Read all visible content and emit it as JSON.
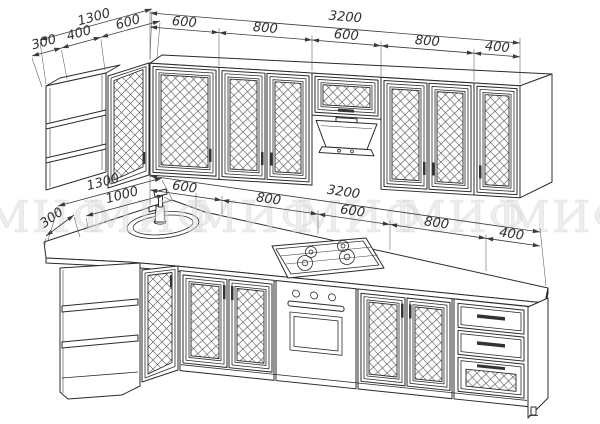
{
  "document": {
    "type": "kitchen furniture technical line drawing, isometric view"
  },
  "watermark": {
    "text": "МИФ",
    "count": 6,
    "color": "#dcdce0"
  },
  "dimensions_mm": {
    "top_left_overall": "1300",
    "top_left_parts": [
      "300",
      "400",
      "600"
    ],
    "top_run_overall": "3200",
    "top_run_parts": [
      "600",
      "800",
      "600",
      "800",
      "400"
    ],
    "bottom_left_overall": "1300",
    "bottom_left_inner": "1000",
    "bottom_left_side": "300",
    "bottom_run_overall": "3200",
    "bottom_run_parts": [
      "600",
      "800",
      "600",
      "800",
      "400"
    ]
  },
  "colors": {
    "line": "#2b2b2b",
    "dim_line": "#3a3a3a",
    "watermark": "#dcdce0",
    "background": "#ffffff"
  }
}
